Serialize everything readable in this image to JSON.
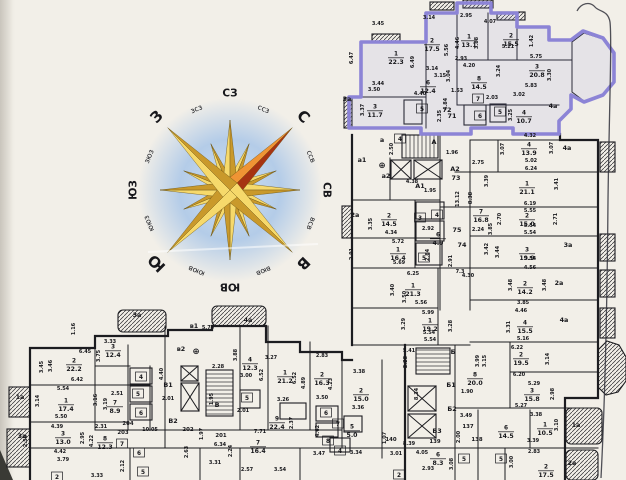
{
  "document": {
    "kind": "scanned floor plan sheet",
    "language": "ru"
  },
  "colors": {
    "paper": "#f2efe8",
    "wall": "#1c1c20",
    "highlight": "#8c84d6",
    "highlight_fill": "#968fdf",
    "compass_gold_light": "#f6d96b",
    "compass_gold_dark": "#c9992b",
    "compass_north_light": "#ef9434",
    "compass_north_dark": "#a63312",
    "compass_halo": "#a9c6e8"
  },
  "compass": {
    "points": [
      {
        "t": "СЗ",
        "a": 0,
        "c": "mid"
      },
      {
        "t": "ссз",
        "a": 22.5,
        "c": "small"
      },
      {
        "t": "С",
        "a": 45,
        "c": "big"
      },
      {
        "t": "ссв",
        "a": 67.5,
        "c": "small"
      },
      {
        "t": "СВ",
        "a": 90,
        "c": "mid"
      },
      {
        "t": "всв",
        "a": 112.5,
        "c": "small"
      },
      {
        "t": "В",
        "a": 135,
        "c": "big"
      },
      {
        "t": "вюв",
        "a": 157.5,
        "c": "small"
      },
      {
        "t": "ЮВ",
        "a": 180,
        "c": "mid"
      },
      {
        "t": "ююв",
        "a": 202.5,
        "c": "small"
      },
      {
        "t": "Ю",
        "a": 225,
        "c": "big"
      },
      {
        "t": "ююз",
        "a": 247.5,
        "c": "small"
      },
      {
        "t": "ЮЗ",
        "a": 270,
        "c": "mid"
      },
      {
        "t": "зюз",
        "a": 292.5,
        "c": "small"
      },
      {
        "t": "З",
        "a": 315,
        "c": "big"
      },
      {
        "t": "зсз",
        "a": 337.5,
        "c": "small"
      }
    ]
  },
  "floorplan": {
    "rooms": [
      {
        "n": "1",
        "a": "22.3",
        "x": 396,
        "y": 57
      },
      {
        "n": "2",
        "a": "17.5",
        "x": 432,
        "y": 44
      },
      {
        "n": "1",
        "a": "13.1",
        "x": 469,
        "y": 40
      },
      {
        "n": "2",
        "a": "15.5",
        "x": 511,
        "y": 39
      },
      {
        "n": "3",
        "a": "20.8",
        "x": 537,
        "y": 70
      },
      {
        "n": "6",
        "a": "12.4",
        "x": 428,
        "y": 86
      },
      {
        "n": "8",
        "a": "14.5",
        "x": 479,
        "y": 82
      },
      {
        "n": "3",
        "a": "11.7",
        "x": 375,
        "y": 110
      },
      {
        "n": "4",
        "a": "10.7",
        "x": 524,
        "y": 116
      },
      {
        "n": "7",
        "x": 478,
        "y": 99
      },
      {
        "n": "6",
        "x": 480,
        "y": 116
      },
      {
        "n": "5",
        "x": 422,
        "y": 109
      },
      {
        "n": "5",
        "x": 500,
        "y": 112
      },
      {
        "n": "4",
        "x": 400,
        "y": 139
      },
      {
        "n": "4",
        "a": "13.9",
        "x": 529,
        "y": 148
      },
      {
        "n": "1",
        "a": "21.1",
        "x": 527,
        "y": 187
      },
      {
        "n": "7",
        "a": "16.8",
        "x": 481,
        "y": 215
      },
      {
        "n": "2",
        "a": "15.0",
        "x": 527,
        "y": 219
      },
      {
        "n": "3",
        "a": "19.9",
        "x": 527,
        "y": 253
      },
      {
        "n": "2",
        "a": "14.2",
        "x": 525,
        "y": 287
      },
      {
        "n": "4",
        "a": "15.5",
        "x": 525,
        "y": 326
      },
      {
        "n": "2",
        "a": "19.5",
        "x": 521,
        "y": 358
      },
      {
        "n": "3",
        "a": "15.8",
        "x": 532,
        "y": 394
      },
      {
        "n": "8",
        "a": "20.0",
        "x": 475,
        "y": 378
      },
      {
        "n": "6",
        "a": "14.5",
        "x": 506,
        "y": 431
      },
      {
        "n": "1",
        "a": "10.5",
        "x": 545,
        "y": 428
      },
      {
        "n": "2",
        "a": "17.5",
        "x": 546,
        "y": 470
      },
      {
        "n": "2",
        "a": "14.5",
        "x": 389,
        "y": 219
      },
      {
        "n": "1",
        "a": "16.4",
        "x": 398,
        "y": 253
      },
      {
        "n": "1",
        "a": "21.3",
        "x": 413,
        "y": 289
      },
      {
        "n": "1",
        "a": "19.2",
        "x": 430,
        "y": 324
      },
      {
        "n": "6",
        "a": "4.9",
        "x": 438,
        "y": 238
      },
      {
        "n": "5",
        "x": 424,
        "y": 258
      },
      {
        "n": "3",
        "x": 420,
        "y": 218
      },
      {
        "n": "4",
        "x": 437,
        "y": 215
      },
      {
        "n": "2",
        "a": "15.0",
        "x": 361,
        "y": 394
      },
      {
        "n": "9",
        "a": "22.4",
        "x": 277,
        "y": 422
      },
      {
        "n": "5",
        "a": "5.0",
        "x": 352,
        "y": 430
      },
      {
        "n": "8",
        "x": 328,
        "y": 441
      },
      {
        "n": "7",
        "x": 338,
        "y": 424
      },
      {
        "n": "6",
        "x": 326,
        "y": 413
      },
      {
        "n": "4",
        "x": 340,
        "y": 451
      },
      {
        "n": "6",
        "a": "8.3",
        "x": 438,
        "y": 458
      },
      {
        "n": "5",
        "x": 464,
        "y": 459
      },
      {
        "n": "5",
        "x": 501,
        "y": 459
      },
      {
        "n": "2",
        "x": 399,
        "y": 475
      },
      {
        "n": "2",
        "a": "22.2",
        "x": 74,
        "y": 364
      },
      {
        "n": "3",
        "a": "12.4",
        "x": 113,
        "y": 350
      },
      {
        "n": "1",
        "a": "17.4",
        "x": 66,
        "y": 404
      },
      {
        "n": "7",
        "a": "8.9",
        "x": 115,
        "y": 406
      },
      {
        "n": "3",
        "a": "13.0",
        "x": 63,
        "y": 437
      },
      {
        "n": "8",
        "a": "12.3",
        "x": 105,
        "y": 442
      },
      {
        "n": "5",
        "x": 138,
        "y": 394
      },
      {
        "n": "6",
        "x": 141,
        "y": 413
      },
      {
        "n": "4",
        "x": 141,
        "y": 377
      },
      {
        "n": "7",
        "x": 122,
        "y": 444
      },
      {
        "n": "6",
        "x": 139,
        "y": 453
      },
      {
        "n": "5",
        "x": 143,
        "y": 472
      },
      {
        "n": "4",
        "a": "12.3",
        "x": 250,
        "y": 363
      },
      {
        "n": "1",
        "a": "21.2",
        "x": 285,
        "y": 376
      },
      {
        "n": "2",
        "a": "16.3",
        "x": 322,
        "y": 378
      },
      {
        "n": "7",
        "a": "16.4",
        "x": 258,
        "y": 446
      },
      {
        "n": "5",
        "x": 247,
        "y": 398
      },
      {
        "n": "2",
        "x": 57,
        "y": 477
      }
    ],
    "dims": [
      [
        "3.45",
        378,
        25
      ],
      [
        "3.14",
        429,
        19
      ],
      [
        "2.95",
        466,
        17
      ],
      [
        "4.07",
        490,
        23
      ],
      [
        "5.21",
        508,
        48
      ],
      [
        "5.75",
        536,
        58
      ],
      [
        "2.93",
        461,
        60
      ],
      [
        "4.20",
        469,
        67
      ],
      [
        "3.14",
        432,
        70
      ],
      [
        "3.15",
        440,
        77
      ],
      [
        "3.44",
        378,
        85
      ],
      [
        "3.50",
        374,
        91
      ],
      [
        "4.40",
        420,
        95
      ],
      [
        "1.53",
        457,
        92
      ],
      [
        "2.03",
        492,
        99
      ],
      [
        "3.02",
        519,
        96
      ],
      [
        "5.83",
        531,
        87
      ],
      [
        "6.47",
        353,
        58,
        1
      ],
      [
        "6.49",
        414,
        62,
        1
      ],
      [
        "5.56",
        448,
        50,
        1
      ],
      [
        "4.46",
        459,
        43,
        1
      ],
      [
        "3.88",
        478,
        43,
        1
      ],
      [
        "1.42",
        533,
        41,
        1
      ],
      [
        "3.24",
        500,
        71,
        1
      ],
      [
        "3.04",
        450,
        76,
        1
      ],
      [
        "3.30",
        551,
        75,
        1
      ],
      [
        "3.37",
        364,
        110,
        1
      ],
      [
        "2.35",
        441,
        116,
        1
      ],
      [
        "3.25",
        512,
        115,
        1
      ],
      [
        "4.84",
        447,
        104,
        1
      ],
      [
        "1.96",
        452,
        154
      ],
      [
        "2.50",
        393,
        149,
        1
      ],
      [
        "4.38",
        412,
        183
      ],
      [
        "1.95",
        430,
        192
      ],
      [
        "13.12",
        459,
        199,
        1
      ],
      [
        "8.38",
        472,
        198,
        1
      ],
      [
        "2.75",
        478,
        164
      ],
      [
        "4.32",
        530,
        137
      ],
      [
        "3.07",
        504,
        149,
        1
      ],
      [
        "3.07",
        553,
        148,
        1
      ],
      [
        "5.02",
        531,
        162
      ],
      [
        "6.24",
        531,
        170
      ],
      [
        "3.41",
        558,
        184,
        1
      ],
      [
        "3.39",
        488,
        181,
        1
      ],
      [
        "6.19",
        530,
        205
      ],
      [
        "5.55",
        530,
        212
      ],
      [
        "2.71",
        557,
        219,
        1
      ],
      [
        "2.70",
        501,
        219,
        1
      ],
      [
        "5.54",
        530,
        227
      ],
      [
        "5.54",
        530,
        234
      ],
      [
        "3.85",
        492,
        229,
        1
      ],
      [
        "2.24",
        478,
        231
      ],
      [
        "3.42",
        488,
        249,
        1
      ],
      [
        "3.44",
        499,
        252,
        1
      ],
      [
        "5.54",
        530,
        260
      ],
      [
        "4.56",
        530,
        269
      ],
      [
        "3.48",
        512,
        285,
        1
      ],
      [
        "3.48",
        546,
        285,
        1
      ],
      [
        "3.85",
        523,
        304
      ],
      [
        "4.46",
        521,
        312
      ],
      [
        "3.31",
        510,
        327,
        1
      ],
      [
        "5.16",
        523,
        340
      ],
      [
        "6.22",
        517,
        349
      ],
      [
        "3.14",
        549,
        359,
        1
      ],
      [
        "3.15",
        486,
        361,
        1
      ],
      [
        "3.99",
        479,
        361,
        1
      ],
      [
        "6.20",
        519,
        376
      ],
      [
        "5.29",
        534,
        385
      ],
      [
        "2.98",
        554,
        394,
        1
      ],
      [
        "5.27",
        521,
        407
      ],
      [
        "3.49",
        466,
        417
      ],
      [
        "3.38",
        536,
        416
      ],
      [
        "3.10",
        558,
        425,
        1
      ],
      [
        "3.39",
        533,
        442
      ],
      [
        "2.83",
        534,
        453
      ],
      [
        "1.90",
        467,
        393
      ],
      [
        "5.41",
        409,
        352
      ],
      [
        "5.54",
        429,
        334
      ],
      [
        "2.28",
        407,
        362,
        1
      ],
      [
        "8.34",
        418,
        394,
        1
      ],
      [
        "2.00",
        460,
        437,
        1
      ],
      [
        "3.01",
        396,
        455
      ],
      [
        "4.05",
        422,
        454
      ],
      [
        "2.93",
        428,
        470
      ],
      [
        "3.08",
        453,
        464,
        1
      ],
      [
        "3.00",
        513,
        462,
        1
      ],
      [
        "3.47",
        319,
        455
      ],
      [
        "3.34",
        356,
        454
      ],
      [
        "3.35",
        372,
        224,
        1
      ],
      [
        "4.34",
        391,
        234
      ],
      [
        "2.92",
        428,
        230
      ],
      [
        "5.72",
        398,
        243
      ],
      [
        "2.91",
        353,
        254,
        1
      ],
      [
        "5.69",
        399,
        264
      ],
      [
        "6.25",
        413,
        275
      ],
      [
        "2.84",
        429,
        255,
        1
      ],
      [
        "7.3",
        460,
        273
      ],
      [
        "4.30",
        468,
        277
      ],
      [
        "2.91",
        452,
        261,
        1
      ],
      [
        "3.40",
        394,
        290,
        1
      ],
      [
        "3.50",
        406,
        297,
        1
      ],
      [
        "5.56",
        421,
        304
      ],
      [
        "5.99",
        428,
        314
      ],
      [
        "3.29",
        405,
        324,
        1
      ],
      [
        "3.28",
        452,
        326,
        1
      ],
      [
        "5.54",
        430,
        341
      ],
      [
        "6.45",
        85,
        353
      ],
      [
        "3.33",
        110,
        343
      ],
      [
        "3.46",
        52,
        366,
        1
      ],
      [
        "3.75",
        100,
        356,
        1
      ],
      [
        "3.45",
        43,
        367,
        1
      ],
      [
        "6.42",
        77,
        381
      ],
      [
        "5.54",
        63,
        390
      ],
      [
        "3.14",
        39,
        401,
        1
      ],
      [
        "2.51",
        117,
        395
      ],
      [
        "3.16",
        97,
        400,
        1
      ],
      [
        "3.19",
        107,
        404,
        1
      ],
      [
        "5.50",
        61,
        418
      ],
      [
        "4.39",
        57,
        428
      ],
      [
        "2.31",
        101,
        428
      ],
      [
        "2.95",
        84,
        438,
        1
      ],
      [
        "4.22",
        93,
        441,
        1
      ],
      [
        "4.42",
        60,
        453
      ],
      [
        "3.79",
        63,
        461
      ],
      [
        "2.50",
        27,
        441,
        1
      ],
      [
        "1.16",
        75,
        329,
        1
      ],
      [
        "3.33",
        97,
        477
      ],
      [
        "2.12",
        124,
        466,
        1
      ],
      [
        "2.63",
        188,
        452,
        1
      ],
      [
        "10.05",
        150,
        431
      ],
      [
        "1.97",
        203,
        434,
        1
      ],
      [
        "7.71",
        260,
        433
      ],
      [
        "6.34",
        220,
        446
      ],
      [
        "3.31",
        215,
        464
      ],
      [
        "2.57",
        247,
        471
      ],
      [
        "3.54",
        280,
        471
      ],
      [
        "2.24",
        232,
        451,
        1
      ],
      [
        "5.74",
        208,
        329
      ],
      [
        "2.28",
        218,
        368
      ],
      [
        "3.00",
        246,
        377
      ],
      [
        "2.01",
        168,
        400
      ],
      [
        "2.01",
        243,
        412
      ],
      [
        "4.40",
        163,
        374,
        1
      ],
      [
        "3.88",
        237,
        355,
        1
      ],
      [
        "1.95",
        213,
        399,
        1
      ],
      [
        "3.27",
        271,
        359
      ],
      [
        "6.52",
        263,
        375,
        1
      ],
      [
        "6.52",
        296,
        378,
        1
      ],
      [
        "2.83",
        322,
        357
      ],
      [
        "4.89",
        305,
        383,
        1
      ],
      [
        "4.23",
        332,
        384,
        1
      ],
      [
        "3.38",
        359,
        373
      ],
      [
        "3.26",
        283,
        401
      ],
      [
        "3.50",
        322,
        399
      ],
      [
        "2.37",
        293,
        423,
        1
      ],
      [
        "4.62",
        319,
        431,
        1
      ],
      [
        "3.36",
        358,
        409
      ],
      [
        "1.07",
        386,
        438,
        1
      ],
      [
        "8.39",
        409,
        445
      ]
    ],
    "labels": [
      [
        "а",
        382,
        142
      ],
      [
        "а1",
        362,
        162
      ],
      [
        "а2",
        386,
        178
      ],
      [
        "⊕",
        382,
        168
      ],
      [
        "А",
        434,
        144
      ],
      [
        "А1",
        420,
        188
      ],
      [
        "А2",
        455,
        171
      ],
      [
        "73",
        456,
        180
      ],
      [
        "71",
        452,
        118
      ],
      [
        "72",
        447,
        112
      ],
      [
        "74",
        462,
        247
      ],
      [
        "75",
        457,
        232
      ],
      [
        "2а",
        355,
        217
      ],
      [
        "3а",
        347,
        101
      ],
      [
        "4а",
        553,
        108
      ],
      [
        "4а",
        567,
        150
      ],
      [
        "3а",
        568,
        247
      ],
      [
        "2а",
        559,
        285
      ],
      [
        "4а",
        564,
        322
      ],
      [
        "1а",
        576,
        427
      ],
      [
        "2а",
        572,
        465
      ],
      [
        "Б",
        453,
        354
      ],
      [
        "Б1",
        451,
        387
      ],
      [
        "Б2",
        452,
        411
      ],
      [
        "Б3",
        437,
        433
      ],
      [
        "137",
        468,
        428
      ],
      [
        "138",
        477,
        441
      ],
      [
        "139",
        435,
        443
      ],
      [
        "140",
        391,
        441
      ],
      [
        "В",
        217,
        407
      ],
      [
        "В1",
        168,
        387
      ],
      [
        "В2",
        173,
        423
      ],
      [
        "в1",
        194,
        328
      ],
      [
        "в2",
        181,
        351
      ],
      [
        "⊕",
        196,
        354
      ],
      [
        "3а",
        137,
        317
      ],
      [
        "4а",
        248,
        322
      ],
      [
        "1а",
        20,
        399
      ],
      [
        "3а",
        22,
        438
      ],
      [
        "201",
        221,
        437
      ],
      [
        "202",
        188,
        431
      ],
      [
        "203",
        123,
        434
      ],
      [
        "204",
        128,
        425
      ]
    ]
  }
}
